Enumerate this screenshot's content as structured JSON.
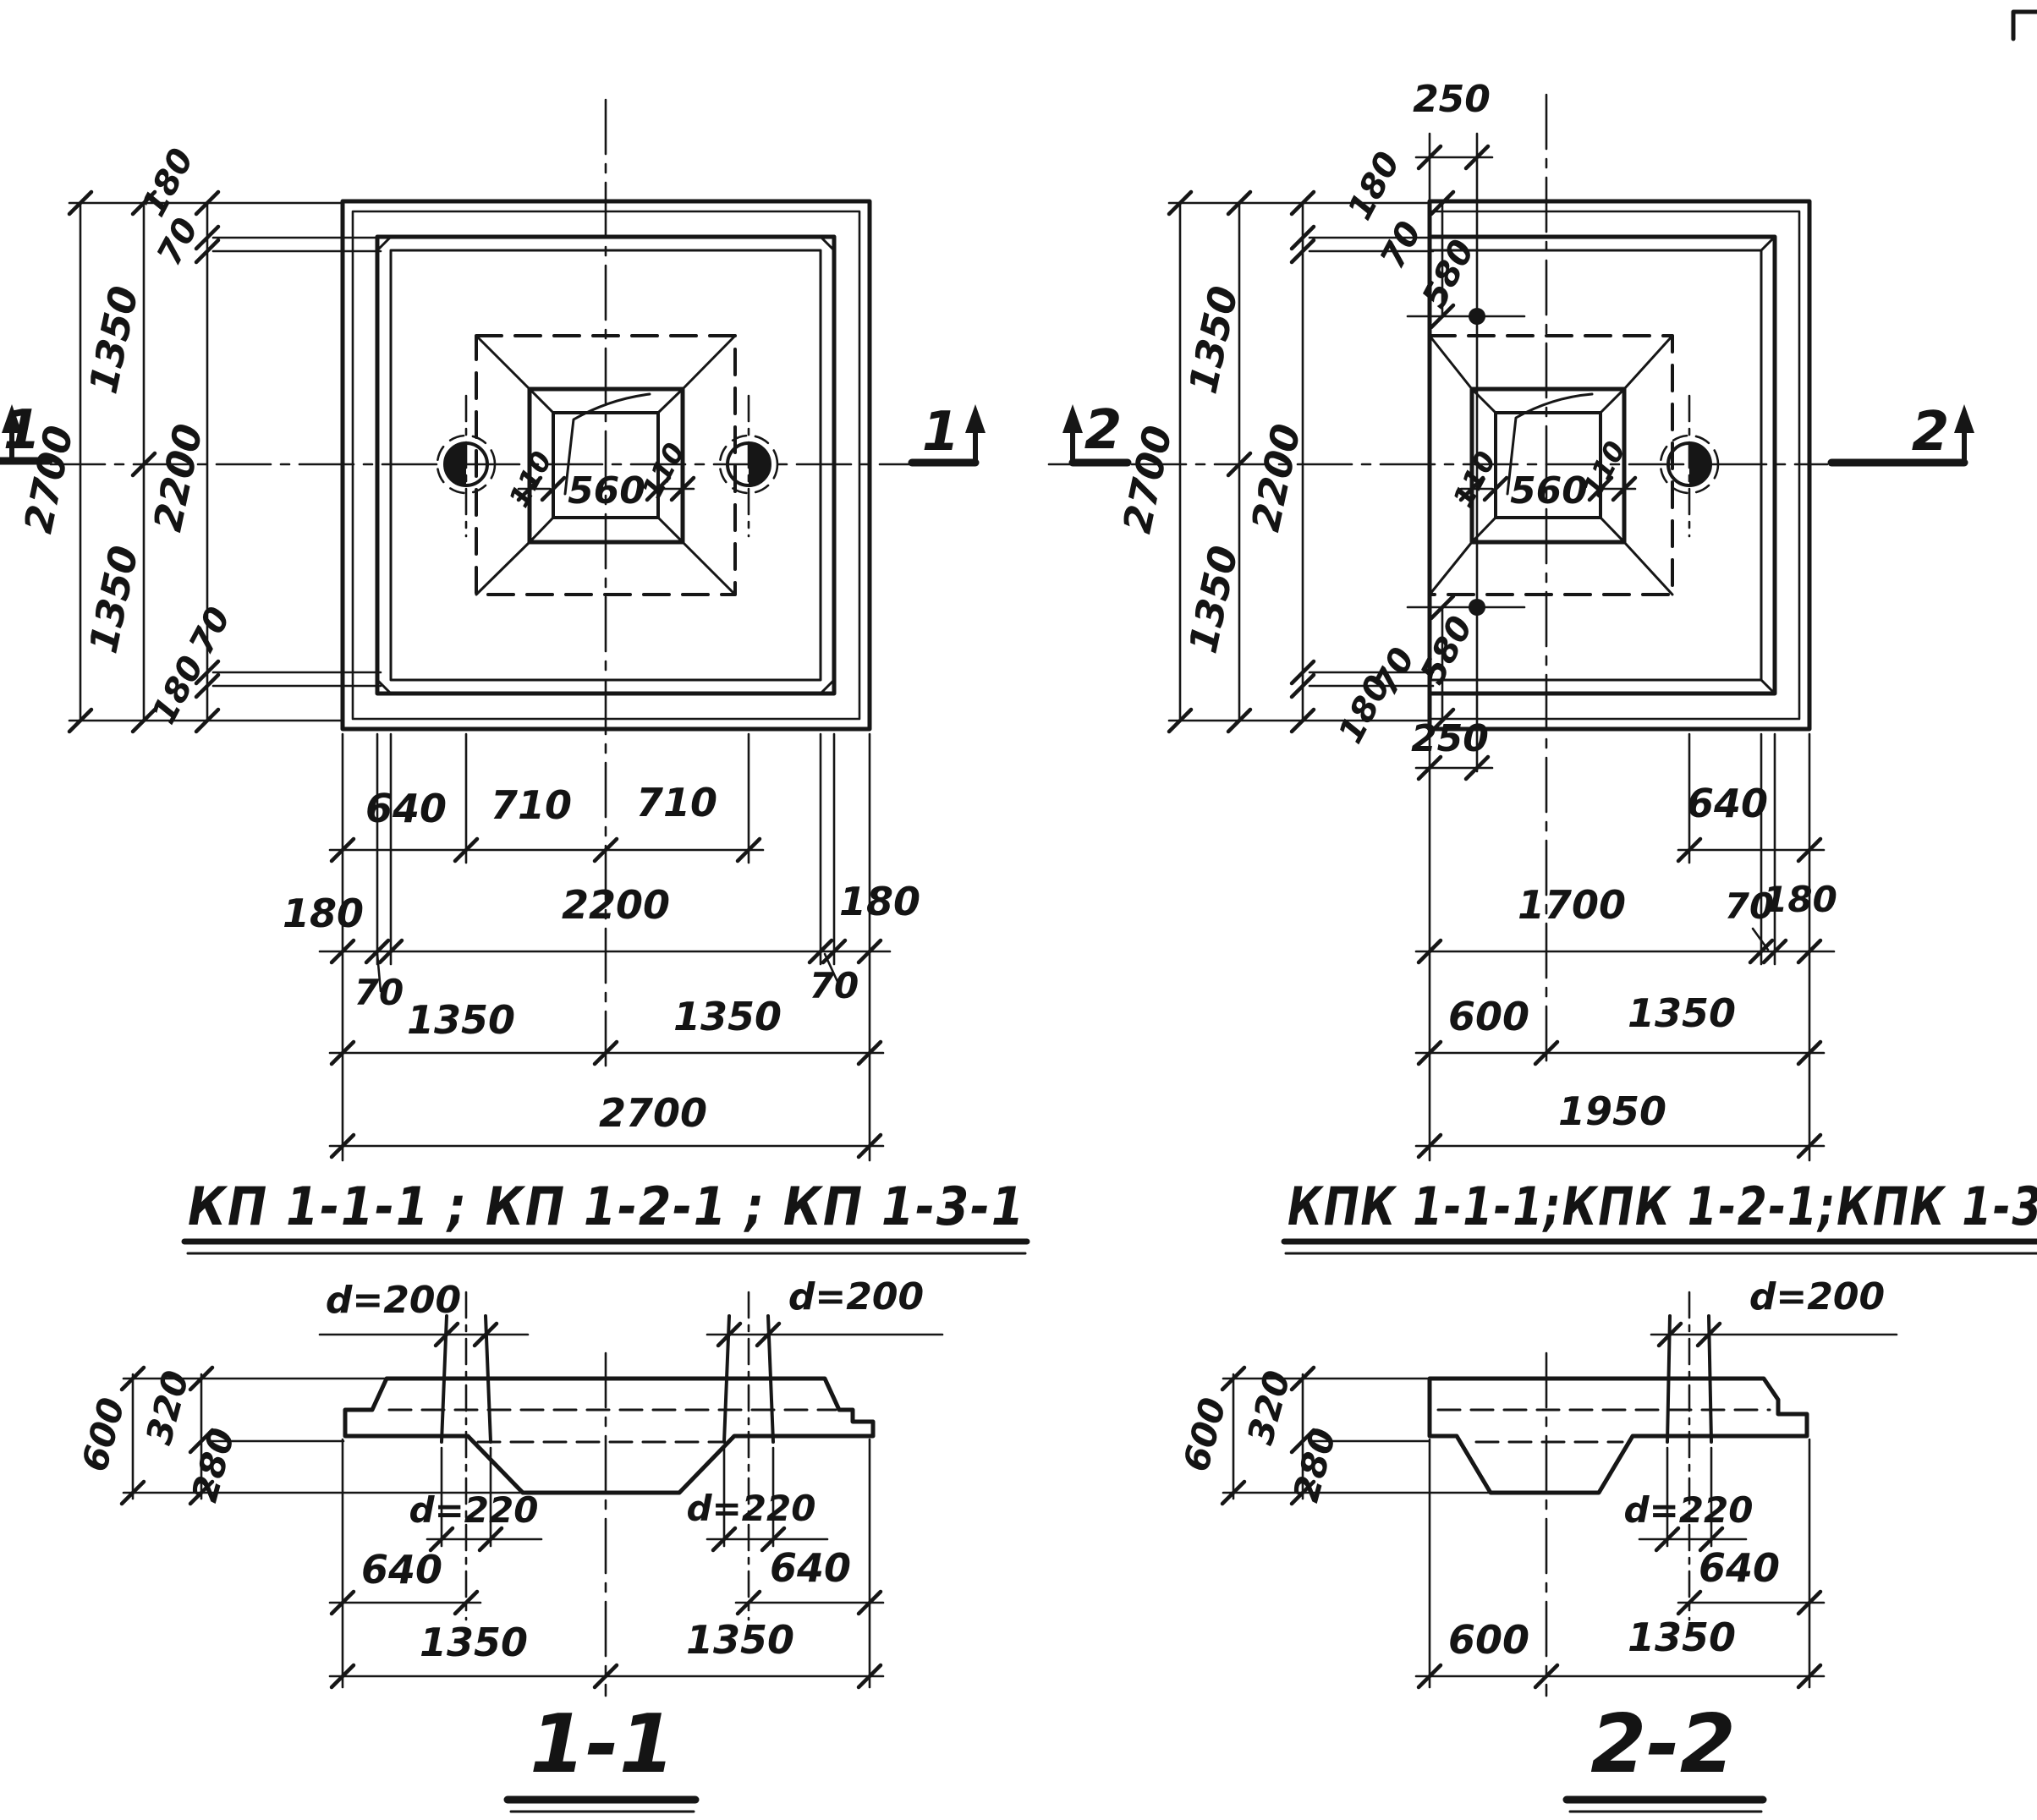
{
  "p1": {
    "title": "КП 1-1-1 ; КП 1-2-1 ; КП 1-3-1",
    "marker_left": "1",
    "marker_right": "1",
    "t180": "180",
    "t70": "70",
    "l1350a": "1350",
    "l2700": "2700",
    "l2200": "2200",
    "l1350b": "1350",
    "b70": "70",
    "b180": "180",
    "c560": "560",
    "c110l": "110",
    "c110r": "110",
    "r640": "640",
    "r710a": "710",
    "r710b": "710",
    "r180l": "180",
    "r2200": "2200",
    "r180r": "180",
    "r70l": "70",
    "r70r": "70",
    "r1350a": "1350",
    "r1350b": "1350",
    "r2700": "2700"
  },
  "p2": {
    "title": "КПК 1-1-1;КПК 1-2-1;КПК 1-3-1",
    "marker_left": "2",
    "marker_right": "2",
    "t250": "250",
    "t180": "180",
    "t70": "70",
    "t580": "580",
    "l1350a": "1350",
    "l2700": "2700",
    "l2200": "2200",
    "l1350b": "1350",
    "b580": "580",
    "b70": "70",
    "b180": "180",
    "b250": "250",
    "c560": "560",
    "c110l": "110",
    "c110r": "110",
    "r640": "640",
    "r1700": "1700",
    "r70": "70",
    "r180": "180",
    "r600": "600",
    "r1350": "1350",
    "r1950": "1950"
  },
  "s1": {
    "title": "1-1",
    "d200l": "d=200",
    "d200r": "d=200",
    "v600": "600",
    "v320": "320",
    "v280": "280",
    "d220l": "d=220",
    "d220r": "d=220",
    "b640l": "640",
    "b640r": "640",
    "b1350l": "1350",
    "b1350r": "1350"
  },
  "s2": {
    "title": "2-2",
    "d200": "d=200",
    "v600": "600",
    "v320": "320",
    "v280": "280",
    "d220": "d=220",
    "b640": "640",
    "b600": "600",
    "b1350": "1350"
  }
}
